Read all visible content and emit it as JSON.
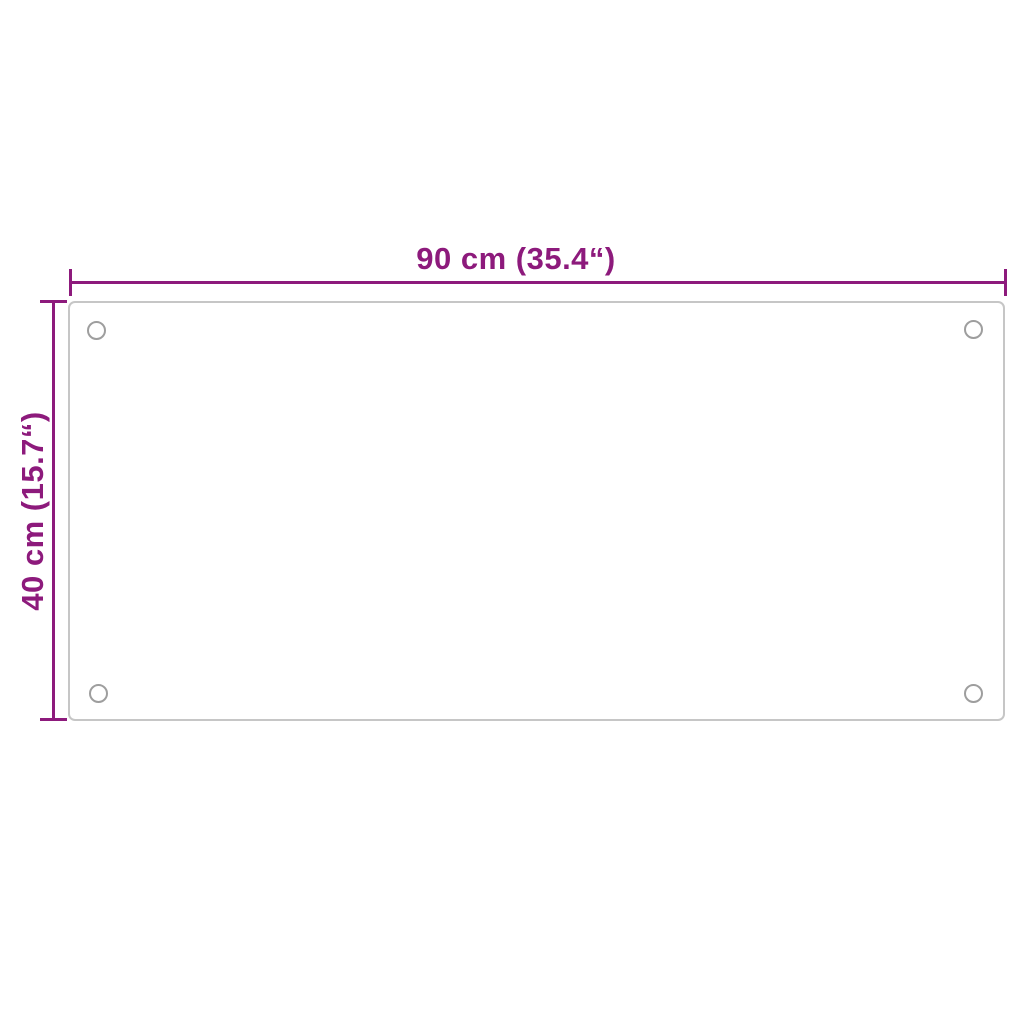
{
  "figure": {
    "type": "product-dimension-diagram"
  },
  "dimensions": {
    "width": {
      "label": "90 cm (35.4“)",
      "cm": 90,
      "inches": 35.4
    },
    "height": {
      "label": "40 cm (15.7“)",
      "cm": 40,
      "inches": 15.7
    }
  },
  "panel": {
    "shape": "rounded-rectangle",
    "hole_count": 4,
    "holes": [
      "top-left",
      "top-right",
      "bottom-left",
      "bottom-right"
    ]
  },
  "colors": {
    "dimension_accent": "#8D1A7C",
    "panel_border": "#C6C6C6",
    "hole_border": "#9E9E9E",
    "background": "#FFFFFF"
  }
}
